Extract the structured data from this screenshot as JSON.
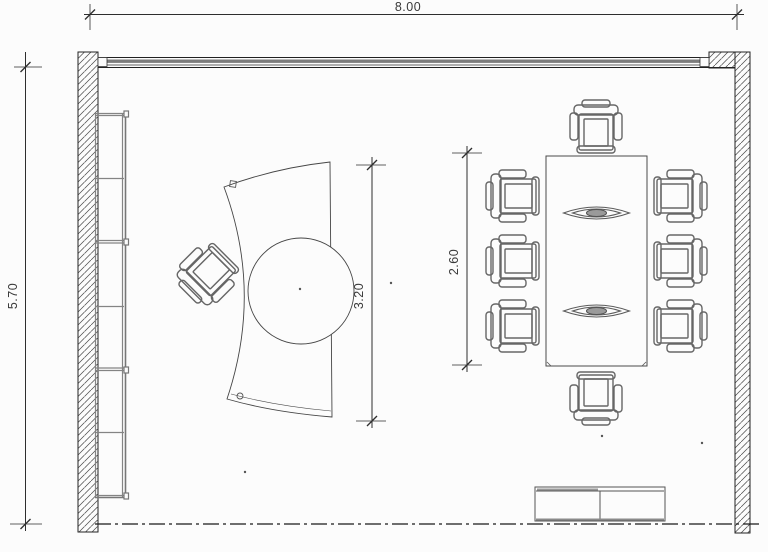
{
  "meta": {
    "type": "architectural-floor-plan",
    "room": "office-meeting-room"
  },
  "dimensions": {
    "width": {
      "label": "8.00",
      "orientation": "horizontal"
    },
    "height": {
      "label": "5.70",
      "orientation": "vertical"
    },
    "desk_span": {
      "label": "3.20",
      "orientation": "vertical"
    },
    "table_span": {
      "label": "2.60",
      "orientation": "vertical"
    }
  },
  "furniture": {
    "wall_shelf": {
      "name": "wall-shelf",
      "compartments": 6
    },
    "executive_desk": {
      "name": "curved-executive-desk-with-round-extension",
      "grommets": 2
    },
    "desk_chair": {
      "name": "executive-swivel-chair",
      "count": 1
    },
    "conference_table": {
      "name": "rectangular-conference-table"
    },
    "conference_chairs": {
      "name": "conference-armchair",
      "count": 8,
      "layout": "3-left-3-right-1-top-1-bottom"
    },
    "table_decor": {
      "name": "leaf-centerpiece",
      "count": 2
    },
    "sideboard": {
      "name": "low-sideboard",
      "doors": 2
    }
  },
  "architecture": {
    "walls": [
      "left-wall-hatched",
      "right-wall-hatched",
      "top-window-band"
    ],
    "window": {
      "name": "glazing-strip-top"
    },
    "section_line": {
      "name": "bottom-dash-dot-line"
    }
  },
  "colors": {
    "background": "#fcfcfc",
    "wall_line": "#222222",
    "dimension_line": "#2e2e2e",
    "furniture_line": "#666666",
    "shelf_line": "#848484",
    "window_glass": "#7d7d7d",
    "text": "#3a3a3a"
  }
}
